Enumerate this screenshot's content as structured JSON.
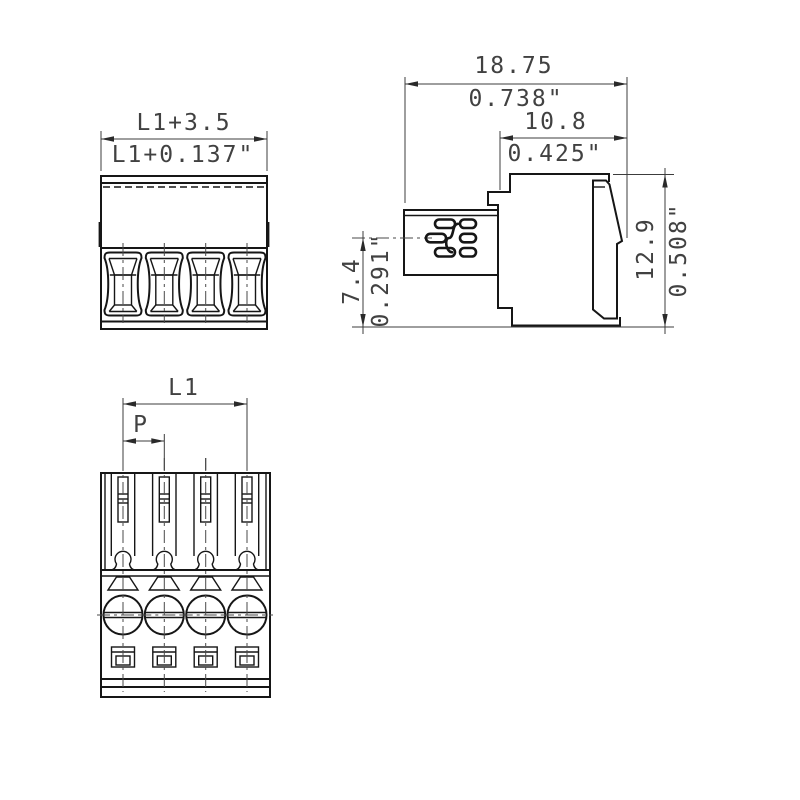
{
  "drawing": {
    "front": {
      "width_mm": "L1+3.5",
      "width_in": "L1+0.137\""
    },
    "side": {
      "overall_width_mm": "18.75",
      "overall_width_in": "0.738\"",
      "upper_width_mm": "10.8",
      "upper_width_in": "0.425\"",
      "height_mm": "12.9",
      "height_in": "0.508\"",
      "clamp_axis_height_mm": "7.4",
      "clamp_axis_height_in": "0.291\""
    },
    "top": {
      "length_label": "L1",
      "pitch_label": "P"
    }
  },
  "colors": {
    "object_line": "#161616",
    "dimension_line": "#3c3c3c",
    "dimension_text": "#414141",
    "background": "#ffffff"
  }
}
